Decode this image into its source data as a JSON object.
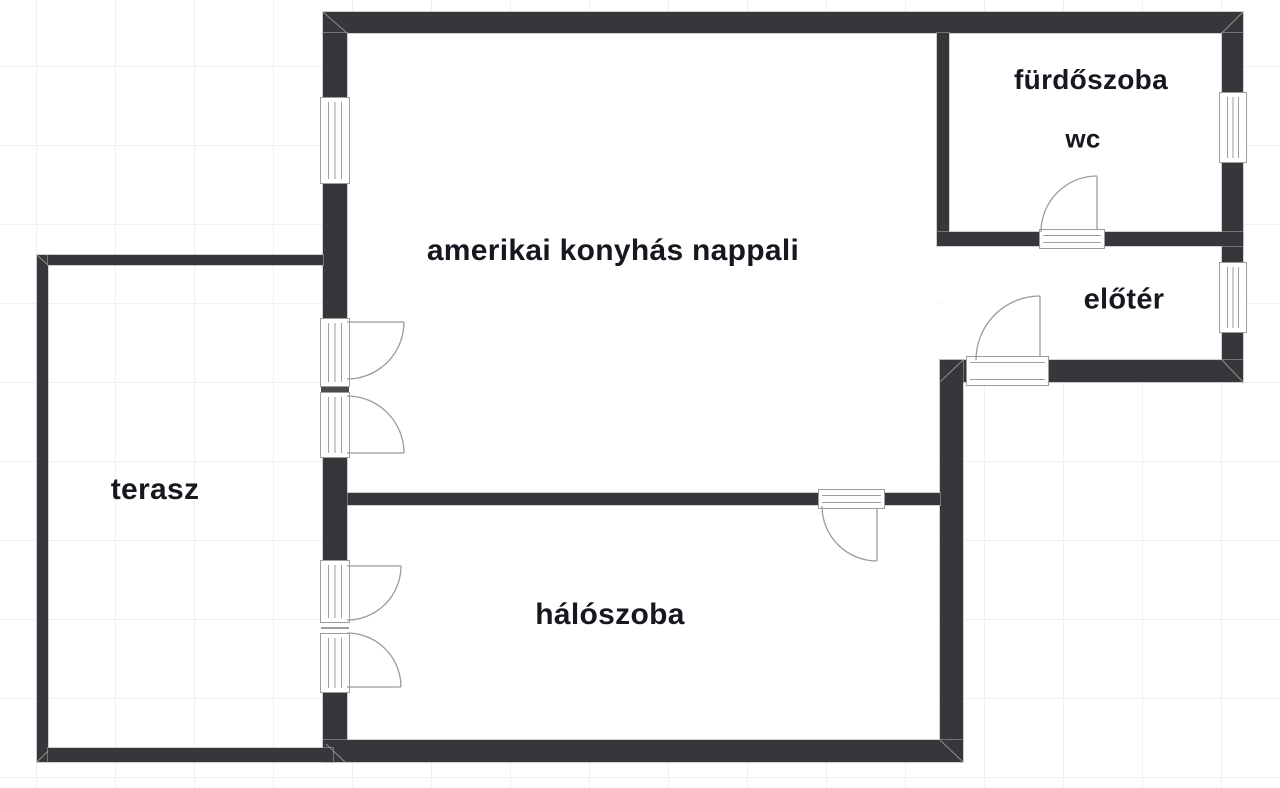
{
  "plan": {
    "type": "apartment floor plan",
    "rooms": {
      "livingroom": "amerikai konyhás nappali",
      "bedroom": "hálószoba",
      "terrace": "terasz",
      "bathroom": "fürdőszoba",
      "wc": "wc",
      "hall": "előtér"
    },
    "colors": {
      "wall": "#36373b",
      "label": "#17171f",
      "grid": "#f0f0f1",
      "fixture": "#9e9e9e",
      "bg": "#ffffff"
    }
  }
}
